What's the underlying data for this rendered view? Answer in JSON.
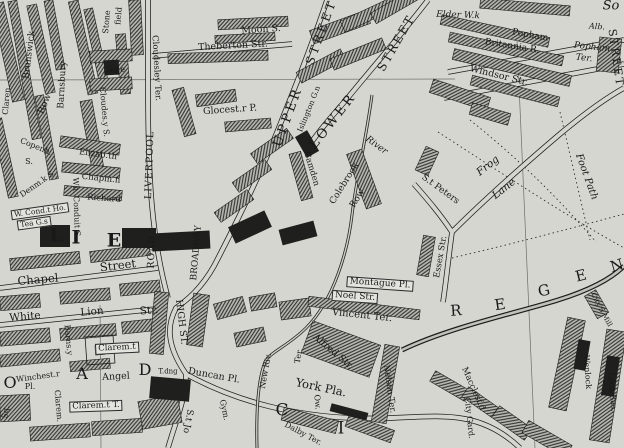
{
  "map": {
    "description": "Engraved 19th-century street map, Islington / Angel area, London",
    "colors": {
      "paper": "#d6d6d1",
      "ink": "#191919"
    },
    "labels": [
      {
        "name": "street-label-brunswick",
        "text": "Brunswick",
        "x": 30,
        "y": 55,
        "r": -83,
        "s": 9
      },
      {
        "name": "street-label-clarence",
        "text": "Claren.",
        "x": 7,
        "y": 100,
        "r": -85,
        "s": 8
      },
      {
        "name": "street-label-row",
        "text": "Row",
        "x": 45,
        "y": 104,
        "r": -68,
        "s": 9.5
      },
      {
        "name": "street-label-barnsbury",
        "text": "Barnsbury",
        "x": 63,
        "y": 85,
        "r": -87,
        "s": 9
      },
      {
        "name": "street-label-stone",
        "text": "Stone",
        "x": 107,
        "y": 22,
        "r": -85,
        "s": 8
      },
      {
        "name": "street-label-field",
        "text": "field",
        "x": 119,
        "y": 16,
        "r": -85,
        "s": 8
      },
      {
        "name": "place-label-square",
        "text": "Sq.e",
        "x": 116,
        "y": 70,
        "r": 0,
        "s": 8
      },
      {
        "name": "street-label-cloudesley-ter",
        "text": "Cloudesley Ter.",
        "x": 156,
        "y": 68,
        "r": 87,
        "s": 8.5
      },
      {
        "name": "street-label-cloudesley-st",
        "text": "Cloudes.y S.",
        "x": 104,
        "y": 112,
        "r": 85,
        "s": 8
      },
      {
        "name": "street-label-theberton",
        "text": "Theberton Str.",
        "x": 233,
        "y": 46,
        "r": -3,
        "s": 9.5
      },
      {
        "name": "street-label-moon",
        "text": "Moon S.",
        "x": 261,
        "y": 30,
        "r": -4,
        "s": 9.5
      },
      {
        "name": "place-label-gloucester",
        "text": "Glocest.r P.",
        "x": 230,
        "y": 110,
        "r": -4,
        "s": 9.5
      },
      {
        "name": "street-label-upper",
        "text": "UPPER",
        "x": 288,
        "y": 117,
        "r": -70,
        "s": 13,
        "ls": 3
      },
      {
        "name": "street-label-upper-street",
        "text": "STREET",
        "x": 321,
        "y": 32,
        "r": -70,
        "s": 12,
        "ls": 3
      },
      {
        "name": "street-label-lower",
        "text": "LOWER",
        "x": 333,
        "y": 121,
        "r": -52,
        "s": 13,
        "ls": 3
      },
      {
        "name": "street-label-lower-street",
        "text": "STREET",
        "x": 396,
        "y": 43,
        "r": -60,
        "s": 12,
        "ls": 2
      },
      {
        "name": "place-label-islington-green",
        "text": "Islington G.n",
        "x": 309,
        "y": 109,
        "r": -68,
        "s": 7.5
      },
      {
        "name": "street-label-camden",
        "text": "Camden",
        "x": 311,
        "y": 169,
        "r": 73,
        "s": 8.5
      },
      {
        "name": "street-label-colebrook",
        "text": "Colebrook",
        "x": 345,
        "y": 184,
        "r": -58,
        "s": 9
      },
      {
        "name": "street-label-colebrook-row",
        "text": "Row",
        "x": 358,
        "y": 199,
        "r": -58,
        "s": 9
      },
      {
        "name": "water-label-river",
        "text": "River",
        "x": 376,
        "y": 146,
        "r": 36,
        "s": 9,
        "it": true
      },
      {
        "name": "street-label-st-peters",
        "text": "S.t Peters",
        "x": 440,
        "y": 190,
        "r": 36,
        "s": 9
      },
      {
        "name": "street-label-frog",
        "text": "Frog",
        "x": 488,
        "y": 166,
        "r": -38,
        "s": 10.5,
        "it": true
      },
      {
        "name": "street-label-lane",
        "text": "Lane",
        "x": 504,
        "y": 189,
        "r": -38,
        "s": 10.5,
        "it": true
      },
      {
        "name": "path-label-foot-path",
        "text": "Foot Path",
        "x": 586,
        "y": 177,
        "r": 70,
        "s": 10,
        "it": true
      },
      {
        "name": "street-label-essex",
        "text": "Essex Str.",
        "x": 441,
        "y": 257,
        "r": -80,
        "s": 8.5
      },
      {
        "name": "place-label-montague",
        "text": "Montague Pl.",
        "x": 380,
        "y": 284,
        "r": 4,
        "s": 9,
        "box": true
      },
      {
        "name": "street-label-noel",
        "text": "Noel Str.",
        "x": 355,
        "y": 297,
        "r": 4,
        "s": 9,
        "box": true
      },
      {
        "name": "place-label-vincent-ter",
        "text": "Vincent Ter.",
        "x": 362,
        "y": 316,
        "r": 6,
        "s": 10
      },
      {
        "name": "street-label-alfred",
        "text": "Alfred Str.",
        "x": 333,
        "y": 352,
        "r": 40,
        "s": 9.5
      },
      {
        "name": "place-label-nelson-ter",
        "text": "Nelson Ter.",
        "x": 389,
        "y": 389,
        "r": 82,
        "s": 8.5
      },
      {
        "name": "place-label-york-place",
        "text": "York Pla.",
        "x": 321,
        "y": 388,
        "r": 12,
        "s": 11.5
      },
      {
        "name": "place-label-elder-walk",
        "text": "Elder W.k",
        "x": 458,
        "y": 16,
        "r": 2,
        "s": 9,
        "it": true
      },
      {
        "name": "street-label-popham",
        "text": "Popham",
        "x": 530,
        "y": 36,
        "r": 10,
        "s": 9
      },
      {
        "name": "street-label-britannia",
        "text": "Britannia R.",
        "x": 512,
        "y": 47,
        "r": 9,
        "s": 9
      },
      {
        "name": "street-label-windsor",
        "text": "Windsor Str.",
        "x": 499,
        "y": 76,
        "r": 14,
        "s": 9.5
      },
      {
        "name": "place-label-popham-ter-line1",
        "text": "Popham",
        "x": 592,
        "y": 48,
        "r": 6,
        "s": 9,
        "it": true
      },
      {
        "name": "place-label-popham-ter-line2",
        "text": "Ter.",
        "x": 584,
        "y": 59,
        "r": 6,
        "s": 9,
        "it": true
      },
      {
        "name": "place-label-albion-fragment",
        "text": "Alb.",
        "x": 597,
        "y": 27,
        "r": 4,
        "s": 8,
        "it": true
      },
      {
        "name": "placename-fragment-so",
        "text": "So",
        "x": 611,
        "y": 6,
        "r": 0,
        "s": 13,
        "it": true
      },
      {
        "name": "street-label-liverpool",
        "text": "LIVERPOOL",
        "x": 150,
        "y": 165,
        "r": -88,
        "s": 9.5,
        "ls": 1
      },
      {
        "name": "street-label-liverpool-road",
        "text": "ROAD",
        "x": 152,
        "y": 252,
        "r": -88,
        "s": 9.5,
        "ls": 1
      },
      {
        "name": "street-label-high-st",
        "text": "HIGH ST.",
        "x": 181,
        "y": 322,
        "r": 83,
        "s": 9.5
      },
      {
        "name": "street-label-broadway",
        "text": "BROADWAY",
        "x": 197,
        "y": 253,
        "r": -85,
        "s": 9
      },
      {
        "name": "street-label-white",
        "text": "White",
        "x": 25,
        "y": 317,
        "r": -5,
        "s": 10.5
      },
      {
        "name": "street-label-lion",
        "text": "Lion",
        "x": 92,
        "y": 312,
        "r": -5,
        "s": 10.5
      },
      {
        "name": "street-label-lion-str",
        "text": "Str.",
        "x": 149,
        "y": 311,
        "r": -5,
        "s": 10.5
      },
      {
        "name": "street-label-barnsbury-2",
        "text": "Barns.y",
        "x": 68,
        "y": 340,
        "r": 85,
        "s": 8
      },
      {
        "name": "place-label-winchester",
        "text": "Winchest.r",
        "x": 38,
        "y": 377,
        "r": -8,
        "s": 8
      },
      {
        "name": "place-label-winchester-pl",
        "text": "Pl.",
        "x": 30,
        "y": 387,
        "r": 0,
        "s": 8
      },
      {
        "name": "place-label-claremont-1",
        "text": "Clarem.t",
        "x": 117,
        "y": 348,
        "r": -3,
        "s": 8.5,
        "box": true
      },
      {
        "name": "place-label-claremont-2",
        "text": "Clarem.t T.",
        "x": 96,
        "y": 406,
        "r": -2,
        "s": 8.5,
        "box": true
      },
      {
        "name": "place-label-angel",
        "text": "Angel",
        "x": 116,
        "y": 377,
        "r": -3,
        "s": 9.5
      },
      {
        "name": "roadname-letter-o",
        "text": "O",
        "x": 10,
        "y": 383,
        "r": 0,
        "s": 16
      },
      {
        "name": "roadname-letter-a",
        "text": "A",
        "x": 82,
        "y": 374,
        "r": 0,
        "s": 16
      },
      {
        "name": "roadname-letter-d",
        "text": "D",
        "x": 145,
        "y": 370,
        "r": 0,
        "s": 16
      },
      {
        "name": "small-label-tdng",
        "text": "T.dng",
        "x": 168,
        "y": 372,
        "r": 0,
        "s": 7
      },
      {
        "name": "place-label-duncan-pl",
        "text": "Duncan Pl.",
        "x": 214,
        "y": 376,
        "r": 10,
        "s": 9.5
      },
      {
        "name": "water-label-new-river",
        "text": "New Riv.",
        "x": 266,
        "y": 371,
        "r": -80,
        "s": 8
      },
      {
        "name": "place-label-ter",
        "text": "Ter.",
        "x": 299,
        "y": 356,
        "r": -80,
        "s": 8
      },
      {
        "name": "street-label-st-john",
        "text": "S.t Jo",
        "x": 187,
        "y": 421,
        "r": 100,
        "s": 9
      },
      {
        "name": "small-label-gym",
        "text": "Gym.",
        "x": 224,
        "y": 410,
        "r": 78,
        "s": 8
      },
      {
        "name": "roadname-letter-c",
        "text": "C",
        "x": 282,
        "y": 411,
        "r": 0,
        "s": 17
      },
      {
        "name": "roadname-letter-i",
        "text": "I",
        "x": 341,
        "y": 429,
        "r": 0,
        "s": 17
      },
      {
        "name": "place-label-dalby-ter",
        "text": "Dalby Ter.",
        "x": 303,
        "y": 434,
        "r": 28,
        "s": 8
      },
      {
        "name": "street-label-owen",
        "text": "Ow.",
        "x": 317,
        "y": 402,
        "r": 85,
        "s": 8
      },
      {
        "name": "street-label-macclesfield",
        "text": "Macclesf.d",
        "x": 473,
        "y": 389,
        "r": 66,
        "s": 8.5
      },
      {
        "name": "place-label-city-gardens",
        "text": "City Gard.",
        "x": 469,
        "y": 418,
        "r": 84,
        "s": 8
      },
      {
        "name": "water-label-wenlock",
        "text": "Wenlock",
        "x": 587,
        "y": 372,
        "r": 86,
        "s": 8
      },
      {
        "name": "water-label-lock-basin",
        "text": "Lock Bas.",
        "x": 612,
        "y": 392,
        "r": 86,
        "s": 8
      },
      {
        "name": "place-label-citys-mill",
        "text": "City'S Mill",
        "x": 601,
        "y": 310,
        "r": 62,
        "s": 7
      },
      {
        "name": "canal-letter-r",
        "text": "R",
        "x": 456,
        "y": 311,
        "r": -4,
        "s": 15
      },
      {
        "name": "canal-letter-e1",
        "text": "E",
        "x": 500,
        "y": 305,
        "r": -8,
        "s": 15
      },
      {
        "name": "canal-letter-g",
        "text": "G",
        "x": 544,
        "y": 291,
        "r": -12,
        "s": 15
      },
      {
        "name": "canal-letter-e2",
        "text": "E",
        "x": 581,
        "y": 276,
        "r": -14,
        "s": 15
      },
      {
        "name": "canal-letter-n",
        "text": "N",
        "x": 617,
        "y": 266,
        "r": -16,
        "s": 15
      },
      {
        "name": "street-label-copenhagen",
        "text": "Copenh.",
        "x": 36,
        "y": 147,
        "r": 22,
        "s": 8
      },
      {
        "name": "street-label-copenhagen-s",
        "text": "S.",
        "x": 29,
        "y": 162,
        "r": 0,
        "s": 8
      },
      {
        "name": "street-label-denmark",
        "text": "Denm.k S.",
        "x": 38,
        "y": 184,
        "r": -35,
        "s": 8
      },
      {
        "name": "street-label-elizabeth",
        "text": "Elizab.th",
        "x": 98,
        "y": 155,
        "r": 8,
        "s": 8.5
      },
      {
        "name": "street-label-chapman",
        "text": "Chapm.n",
        "x": 101,
        "y": 179,
        "r": 6,
        "s": 8.5
      },
      {
        "name": "street-label-richard",
        "text": "Richard",
        "x": 104,
        "y": 199,
        "r": 4,
        "s": 8.5
      },
      {
        "name": "street-label-white-conduit",
        "text": "Wh. Conduit S.",
        "x": 76,
        "y": 208,
        "r": 88,
        "s": 8
      },
      {
        "name": "place-label-conduit-house",
        "text": "W. Cond.t Ho.",
        "x": 40,
        "y": 211,
        "r": -8,
        "s": 7.5,
        "box": true
      },
      {
        "name": "place-label-tea-gardens",
        "text": "Tea G.s",
        "x": 34,
        "y": 223,
        "r": -8,
        "s": 7.5,
        "box": true
      },
      {
        "name": "street-label-chapel",
        "text": "Chapel",
        "x": 38,
        "y": 280,
        "r": -5,
        "s": 11.5
      },
      {
        "name": "street-label-chapel-street",
        "text": "Street",
        "x": 118,
        "y": 266,
        "r": -7,
        "s": 11.5
      },
      {
        "name": "district-letter-l",
        "text": "L",
        "x": 56,
        "y": 236,
        "r": 0,
        "s": 19,
        "bold": true
      },
      {
        "name": "district-letter-i",
        "text": "I",
        "x": 76,
        "y": 238,
        "r": 0,
        "s": 19,
        "bold": true
      },
      {
        "name": "district-letter-e",
        "text": "E",
        "x": 114,
        "y": 241,
        "r": 0,
        "s": 19,
        "bold": true
      },
      {
        "name": "place-label-square-left",
        "text": "Sq.",
        "x": 6,
        "y": 412,
        "r": -80,
        "s": 8
      },
      {
        "name": "place-label-claremont-3",
        "text": "Clarem.",
        "x": 58,
        "y": 406,
        "r": 85,
        "s": 8
      },
      {
        "name": "street-label-street-right-edge",
        "text": "STREET",
        "x": 616,
        "y": 58,
        "r": 82,
        "s": 11,
        "ls": 2
      }
    ]
  }
}
